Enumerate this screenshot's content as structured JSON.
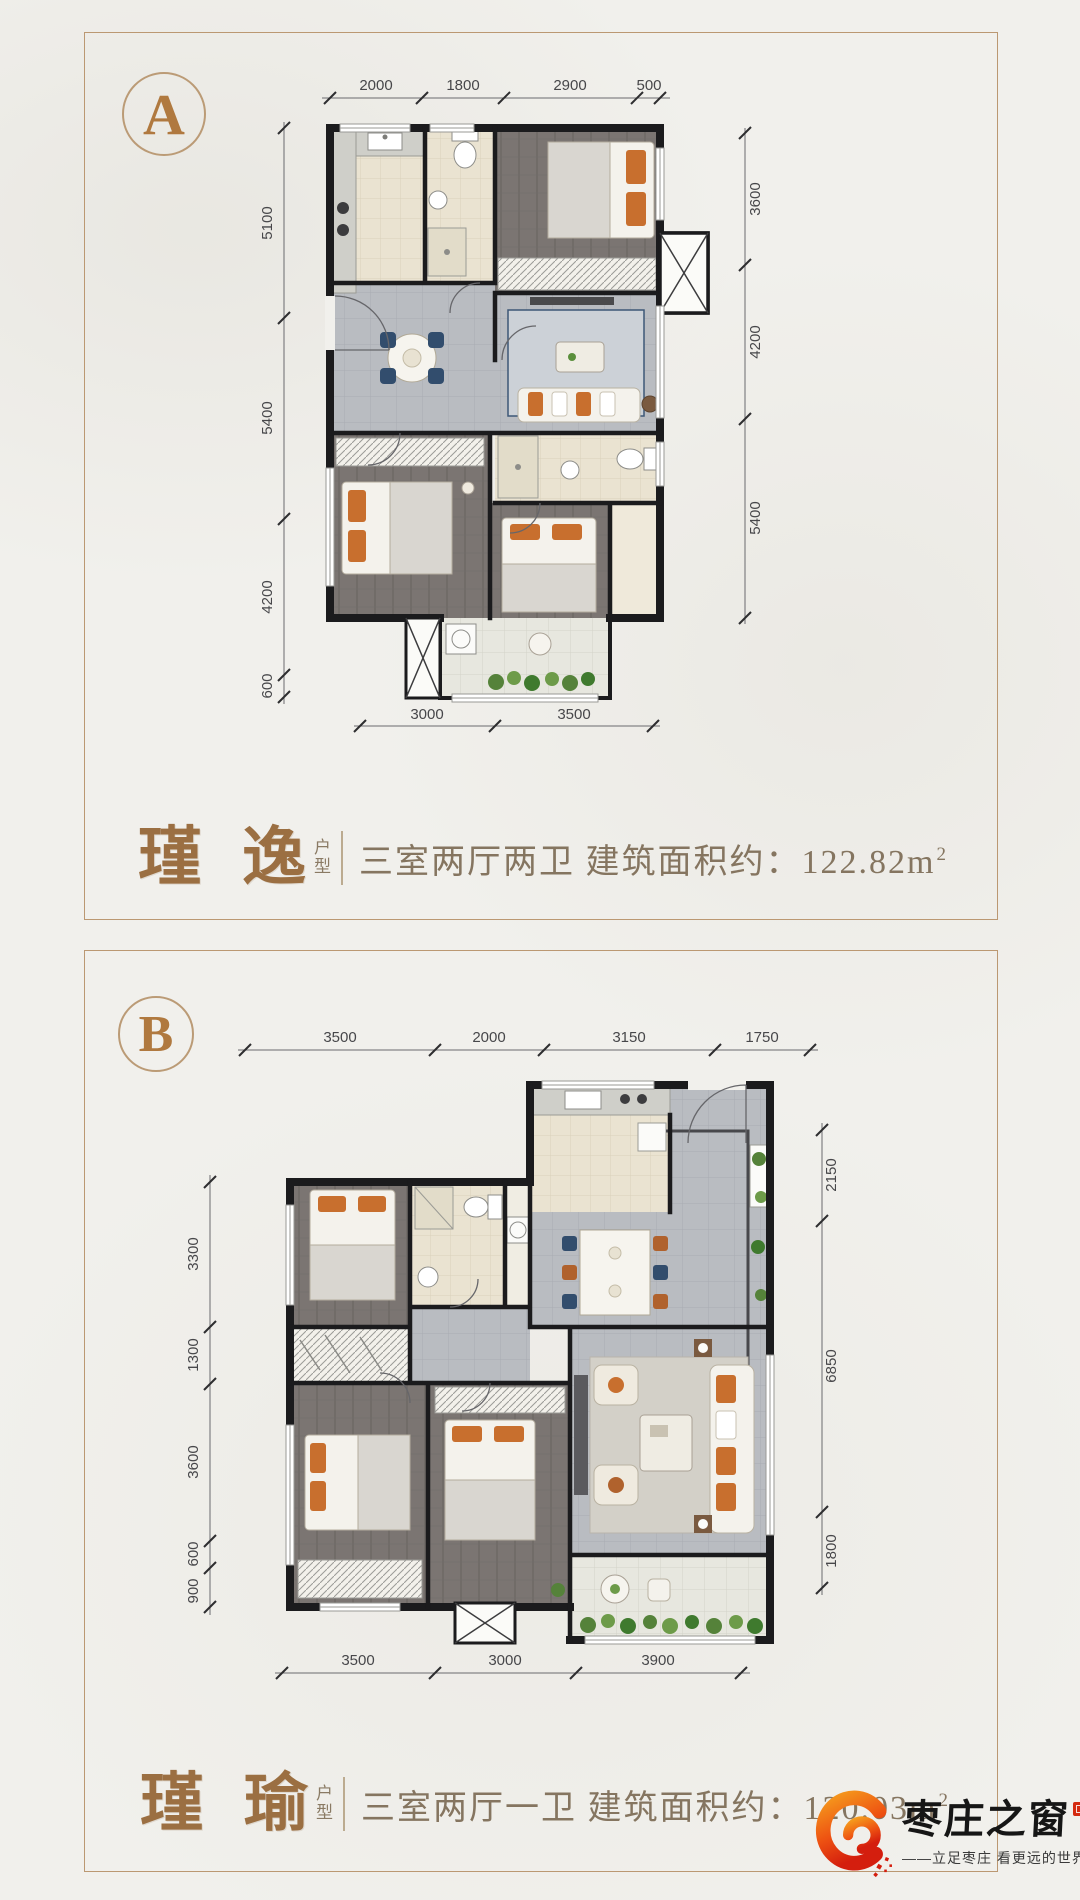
{
  "planA": {
    "badge": "A",
    "dims": {
      "top": [
        "2000",
        "1800",
        "2900",
        "500"
      ],
      "left": [
        "5100",
        "5400",
        "4200",
        "600"
      ],
      "right": [
        "3600",
        "4200",
        "5400"
      ],
      "bottom": [
        "3000",
        "3500"
      ]
    },
    "caption": {
      "name": "瑾 逸",
      "unit_label_top": "户",
      "unit_label_bottom": "型",
      "description": "三室两厅两卫  建筑面积约：122.82m",
      "area_exponent": "2"
    }
  },
  "planB": {
    "badge": "B",
    "dims": {
      "top": [
        "3500",
        "2000",
        "3150",
        "1750"
      ],
      "left": [
        "3300",
        "1300",
        "3600",
        "600",
        "900"
      ],
      "right": [
        "2150",
        "6850",
        "1800"
      ],
      "bottom": [
        "3500",
        "3000",
        "3900"
      ]
    },
    "caption": {
      "name": "瑾 瑜",
      "unit_label_top": "户",
      "unit_label_bottom": "型",
      "description": "三室两厅一卫  建筑面积约：120.03m",
      "area_exponent": "2"
    }
  },
  "logo": {
    "brand": "枣庄之窗",
    "tagline": "——立足枣庄  看更远的世界——"
  },
  "colors": {
    "accent_bronze": "#9b6f42",
    "caption_text": "#857560",
    "panel_border": "#bb9872",
    "logo_orange": "#f59b1d",
    "logo_red": "#e02410",
    "wall": "#1b1b1d",
    "furniture_accent_orange": "#c86f2e",
    "furniture_accent_navy": "#324d6d"
  }
}
